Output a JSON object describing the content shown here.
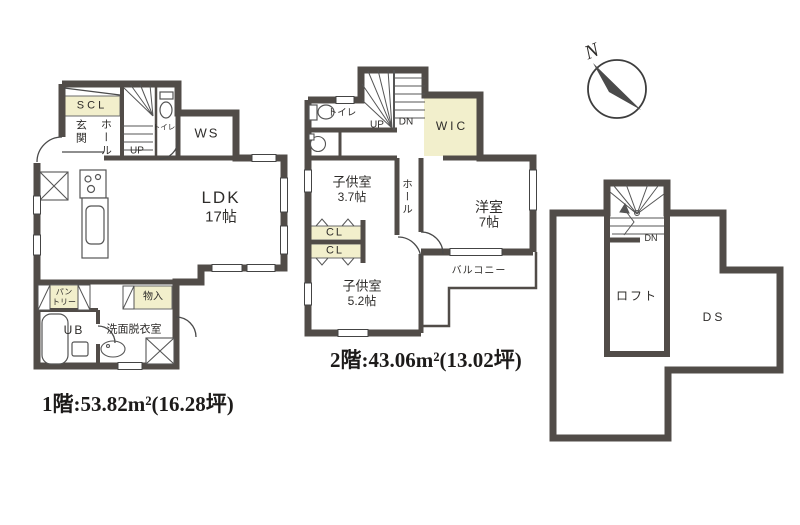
{
  "colors": {
    "wall": "#514c48",
    "thin_line": "#4a4a4a",
    "storage_fill": "#f2efcc",
    "text": "#2e2c2a",
    "background": "#ffffff"
  },
  "compass": {
    "north": "N"
  },
  "floor1": {
    "area": "1階:53.82m²(16.28坪)",
    "scl": "SCL",
    "genkan": "玄関",
    "hall": "ホール",
    "stairs_up": "UP",
    "toilet": "トイレ",
    "ws": "WS",
    "ldk_name": "LDK",
    "ldk_size": "17帖",
    "pantry_l1": "パン",
    "pantry_l2": "トリー",
    "ub": "UB",
    "washroom": "洗面脱衣室",
    "storage": "物入"
  },
  "floor2": {
    "area": "2階:43.06m²(13.02坪)",
    "toilet": "トイレ",
    "stairs_up": "UP",
    "stairs_dn": "DN",
    "wic": "WIC",
    "kids1_name": "子供室",
    "kids1_size": "3.7帖",
    "hall": "ホール",
    "western_name": "洋室",
    "western_size": "7帖",
    "cl1": "CL",
    "cl2": "CL",
    "kids2_name": "子供室",
    "kids2_size": "5.2帖",
    "balcony": "バルコニー"
  },
  "loft": {
    "stairs_dn": "DN",
    "loft": "ロフト",
    "ds": "DS"
  }
}
